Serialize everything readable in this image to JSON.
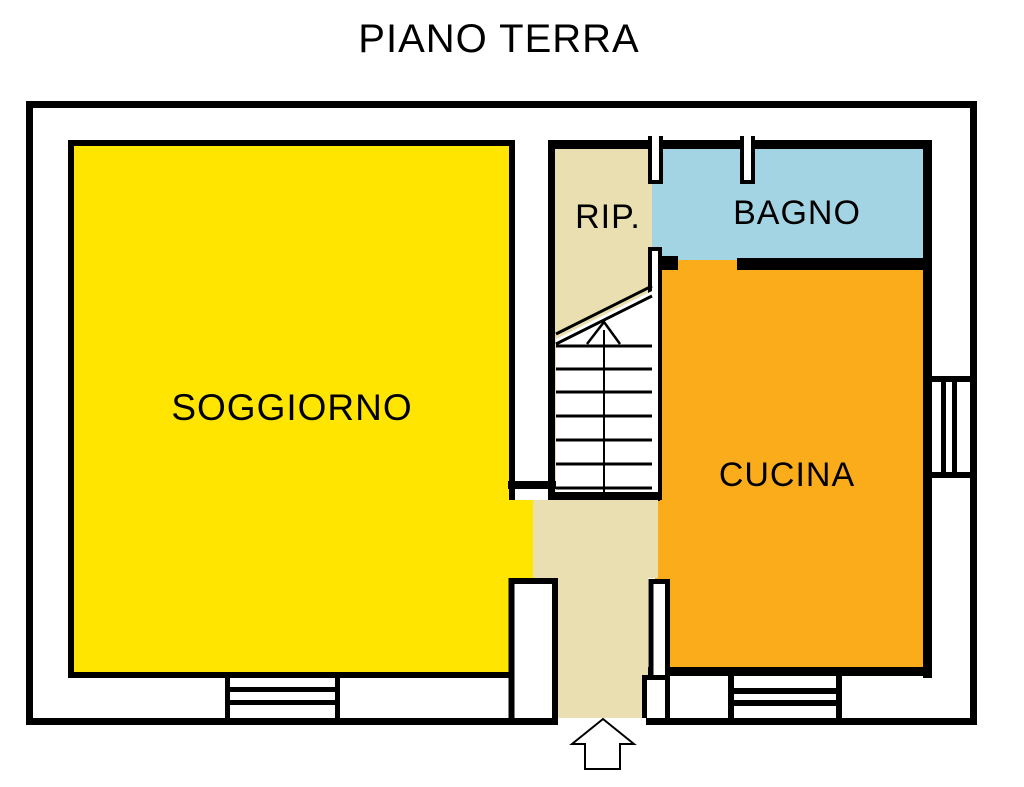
{
  "title": "PIANO TERRA",
  "floor_plan": {
    "background_color": "#FFFFFF",
    "wall_color": "#000000",
    "rooms": [
      {
        "id": "soggiorno",
        "label": "SOGGIORNO",
        "color": "#FFE500"
      },
      {
        "id": "ripostiglio",
        "label": "RIP.",
        "color": "#EADFB0"
      },
      {
        "id": "bagno",
        "label": "BAGNO",
        "color": "#A3D4E3"
      },
      {
        "id": "cucina",
        "label": "CUCINA",
        "color": "#FAAC1A"
      }
    ],
    "icons": {
      "stairs_direction": "up-arrow-icon",
      "entrance": "entrance-up-arrow-icon"
    }
  }
}
